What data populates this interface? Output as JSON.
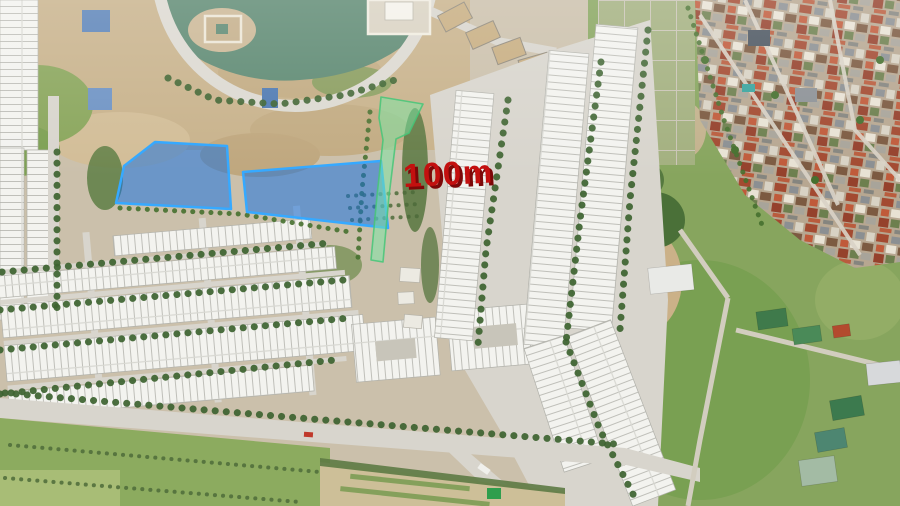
{
  "annotations": {
    "distance_label": {
      "text": "100m",
      "color": "#c3100f",
      "shadow_color": "#7c0808"
    },
    "highlighted_plots": {
      "fill": "rgba(20,112,226,0.52)",
      "border": "#36a9ff"
    },
    "highlighted_path": {
      "fill": "rgba(120,232,165,0.5)",
      "border": "rgba(70,198,120,0.85)"
    }
  }
}
